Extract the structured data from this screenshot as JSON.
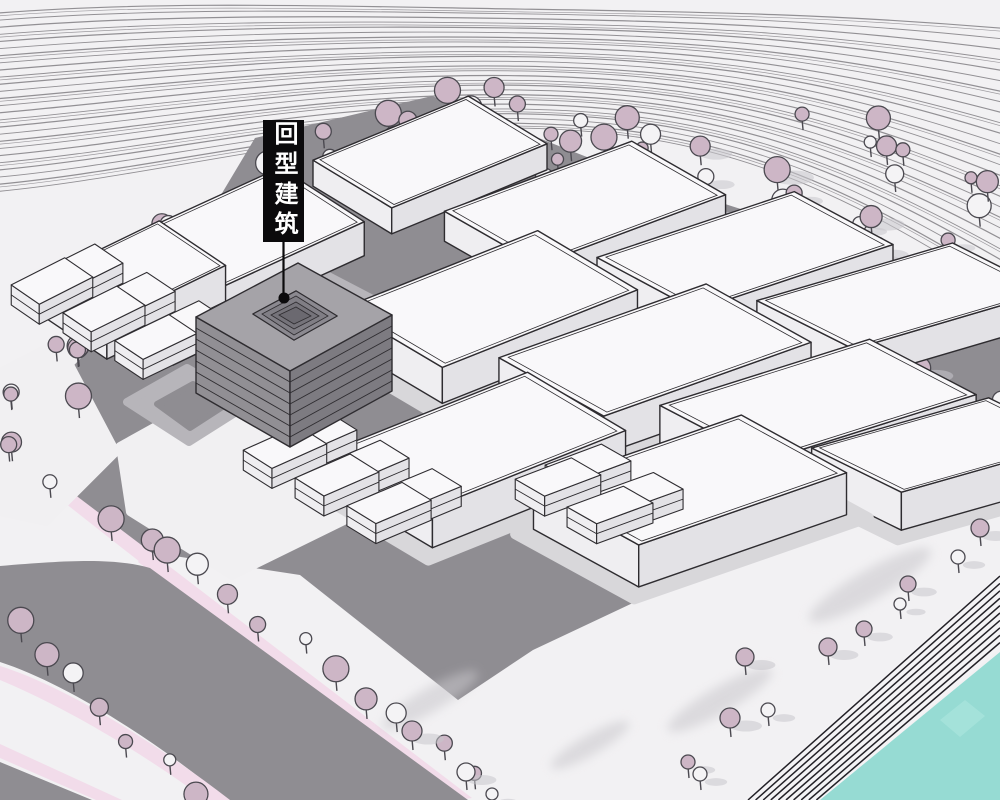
{
  "annotation": {
    "label": "回型建筑",
    "marker": "dot-with-leader-line"
  },
  "colors": {
    "background": "#f2f1f3",
    "contour_line": "#87858a",
    "site_ground": "#8f8d92",
    "plaza_pad_light": "#b7b5ba",
    "parcel_white": "#f1f0f2",
    "building_roof": "#f9f8fa",
    "building_left": "#efeef1",
    "building_right": "#e3e2e6",
    "building_outline": "#2e2c30",
    "building_skirt": "#d8d7da",
    "courtyard_roof": "#a5a3a8",
    "courtyard_left": "#918f94",
    "courtyard_right": "#7d7b81",
    "courtyard_inner": "#8b8990",
    "tree_pink": "#cdb6c6",
    "tree_white": "#f4f3f5",
    "tree_outline": "#4b4950",
    "tree_shadow": "#c9c7cc",
    "sidewalk_pink": "#f2dcea",
    "road_gray": "#8f8d92",
    "stairs_stripe": "#232127",
    "water_teal": "#96dbd3",
    "label_bg": "#0b0a0c",
    "label_text": "#ffffff"
  }
}
